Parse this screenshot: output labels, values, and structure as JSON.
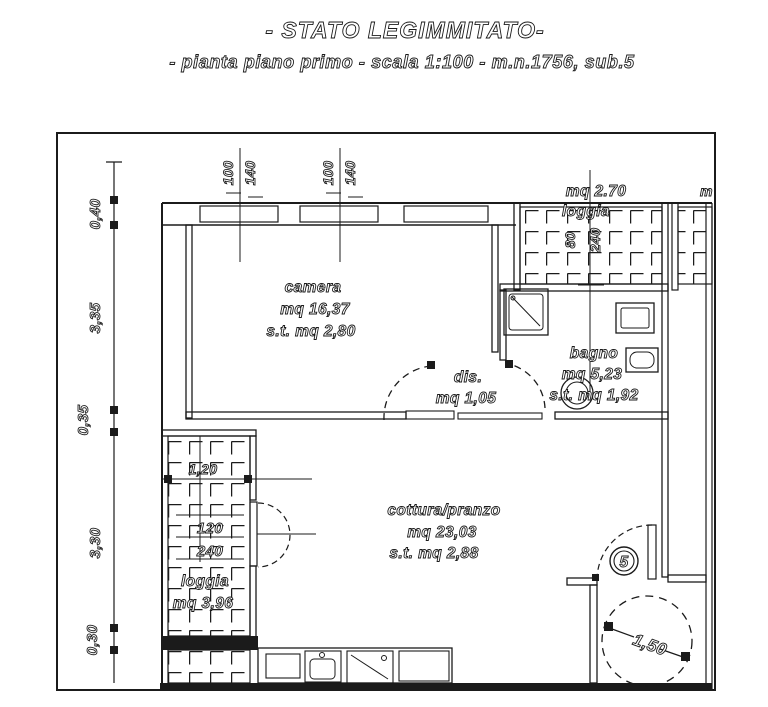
{
  "title": {
    "line1": "- STATO LEGIMMITATO-",
    "line2": "- pianta piano primo -  scala 1:100  - m.n.1756, sub.5"
  },
  "rooms": {
    "camera": {
      "name": "camera",
      "area": "mq 16,37",
      "st": "s.t. mq 2,80"
    },
    "dis": {
      "name": "dis.",
      "area": "mq 1,05"
    },
    "bagno": {
      "name": "bagno",
      "area": "mq 5,23",
      "st": "s.t. mq 1,92"
    },
    "cottura": {
      "name": "cottura/pranzo",
      "area": "mq 23,03",
      "st": "s.t. mq 2,88"
    },
    "loggia_left": {
      "name": "loggia",
      "area": "mq 3,96"
    },
    "loggia_top": {
      "name": "loggia",
      "area": "mq 2.70"
    },
    "loggia_right_partial": "m"
  },
  "dims": {
    "left_chain": [
      "0,40",
      "3,35",
      "0,35",
      "3,30",
      "0,30"
    ],
    "window_a": {
      "w": "100",
      "h": "140"
    },
    "window_b": {
      "w": "100",
      "h": "140"
    },
    "loggia_top": {
      "w": "80",
      "h": "240"
    },
    "loggia_left": {
      "w": "1,20",
      "win_w": "120",
      "win_h": "240"
    },
    "turning_circle": "1,50",
    "unit_number": "5"
  },
  "colors": {
    "ink": "#1b1b1b",
    "paper": "#ffffff"
  }
}
